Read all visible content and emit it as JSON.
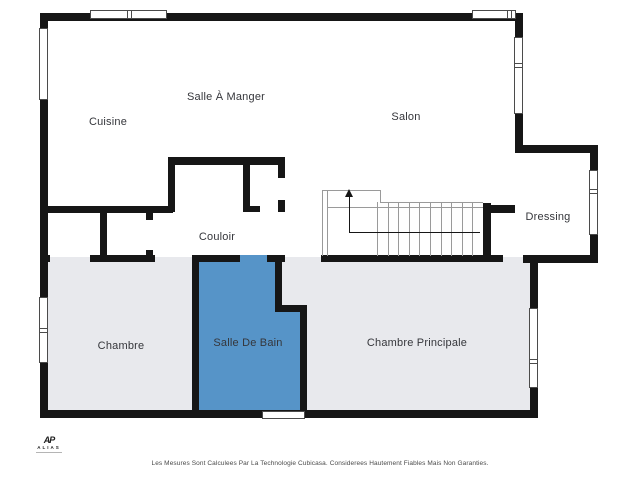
{
  "floorplan": {
    "rooms": [
      {
        "id": "cuisine",
        "label": "Cuisine"
      },
      {
        "id": "salle-a-manger",
        "label": "Salle À Manger"
      },
      {
        "id": "salon",
        "label": "Salon"
      },
      {
        "id": "couloir",
        "label": "Couloir"
      },
      {
        "id": "dressing",
        "label": "Dressing"
      },
      {
        "id": "chambre",
        "label": "Chambre"
      },
      {
        "id": "salle-de-bain",
        "label": "Salle De Bain"
      },
      {
        "id": "chambre-principale",
        "label": "Chambre Principale"
      }
    ],
    "icons": {
      "stairs_direction": "arrow-up-icon"
    },
    "colors": {
      "wall": "#161616",
      "room_upper": "#ffffff",
      "room_lower": "#e8e9ed",
      "bathroom": "#5694c8",
      "stairs_line": "#9a9a9a"
    }
  },
  "branding": {
    "logo_monogram": "AP",
    "logo_name": "ALIAS"
  },
  "footer": {
    "disclaimer": "Les Mesures Sont Calculees Par La Technologie Cubicasa. Considerees Hautement Fiables Mais Non Garanties."
  }
}
